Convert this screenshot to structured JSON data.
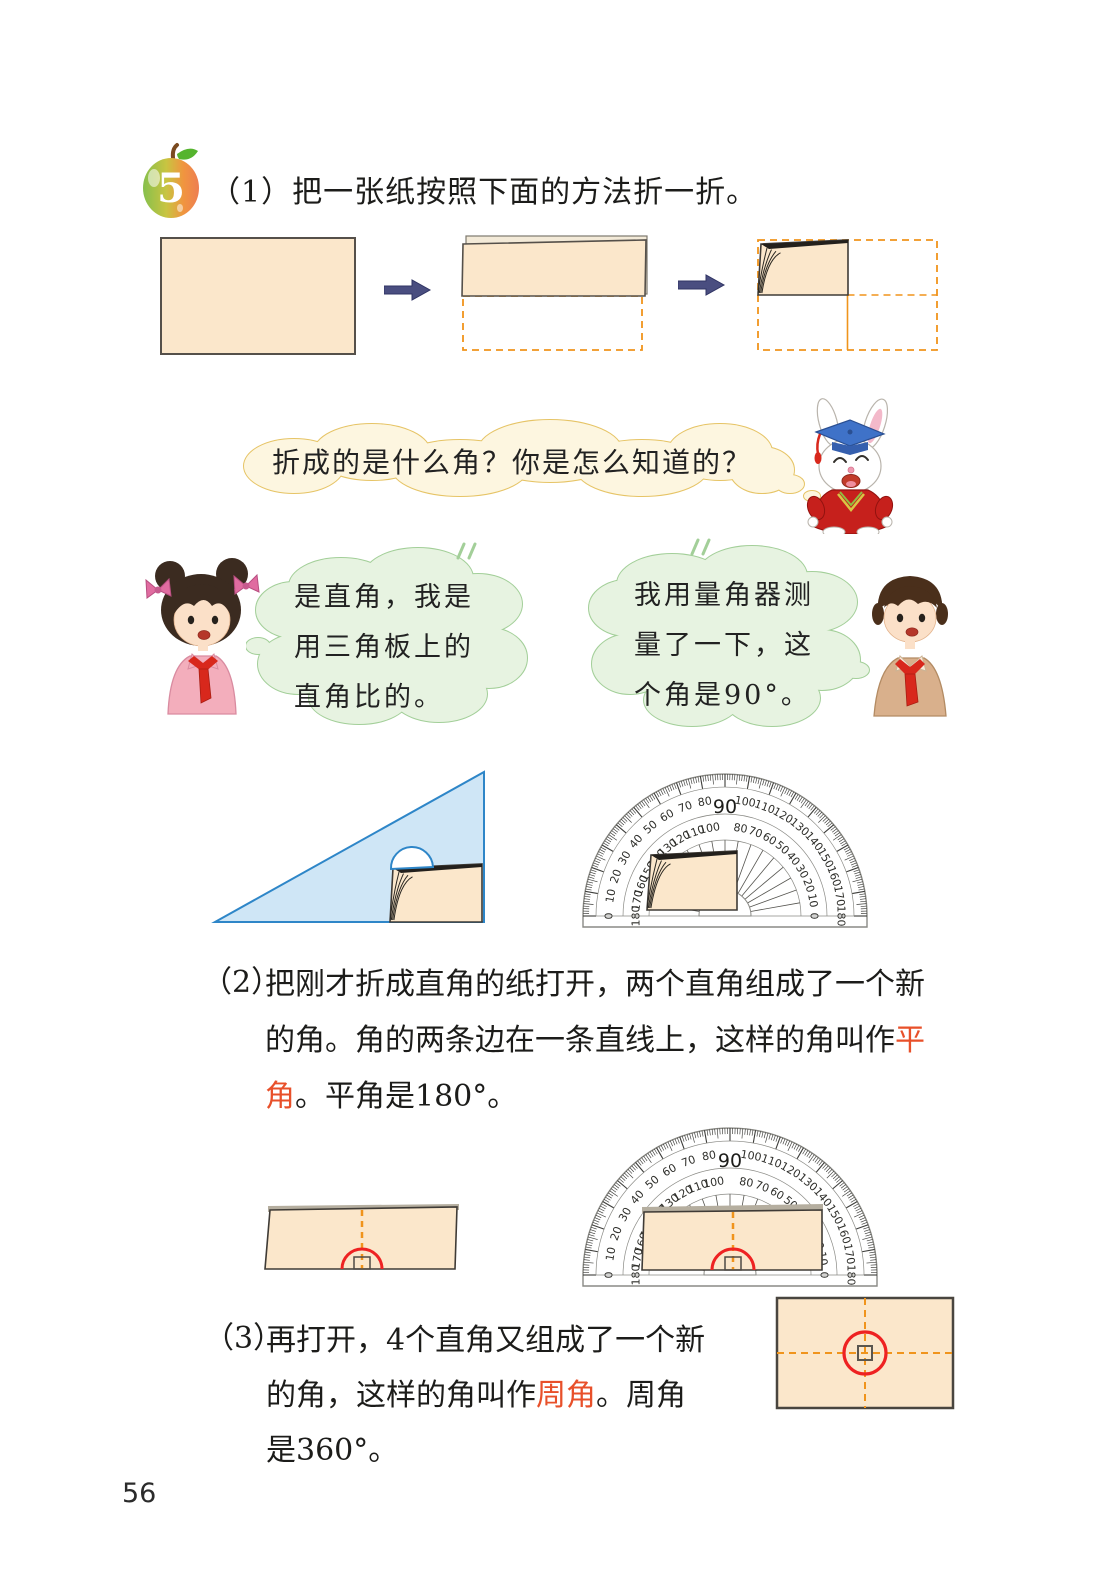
{
  "header": {
    "badge_number": "5",
    "text": "（1）把一张纸按照下面的方法折一折。"
  },
  "bubbles": {
    "rabbit": "折成的是什么角？你是怎么知道的？",
    "girl_lines": [
      "是直角，我是",
      "用三角板上的",
      "直角比的。"
    ],
    "boy_lines": [
      "我用量角器测",
      "量了一下，这",
      "个角是90°。"
    ]
  },
  "paragraph2": {
    "label": "（2）",
    "lines": [
      [
        {
          "t": "把刚才折成直角的纸打开，两个直角组成了一个新"
        }
      ],
      [
        {
          "t": "的角。角的两条边在一条直线上，这样的角叫作"
        },
        {
          "t": "平",
          "red": true
        }
      ],
      [
        {
          "t": "角",
          "red": true
        },
        {
          "t": "。平角是180°。"
        }
      ]
    ]
  },
  "paragraph3": {
    "label": "（3）",
    "lines": [
      [
        {
          "t": "再打开，4个直角又组成了一个新"
        }
      ],
      [
        {
          "t": "的角，这样的角叫作"
        },
        {
          "t": "周角",
          "red": true
        },
        {
          "t": "。周角"
        }
      ],
      [
        {
          "t": "是360°。"
        }
      ]
    ]
  },
  "protractor": {
    "outer_labels": [
      0,
      10,
      20,
      30,
      40,
      50,
      60,
      70,
      80,
      100,
      110,
      120,
      130,
      140,
      150,
      160,
      170,
      180
    ],
    "inner_labels": [
      180,
      170,
      160,
      150,
      140,
      130,
      120,
      110,
      100,
      80,
      70,
      60,
      50,
      40,
      30,
      20,
      10,
      0
    ],
    "top_label": "90"
  },
  "page_number": "56",
  "colors": {
    "paper": "#fbe7cb",
    "paper_border": "#3f3b36",
    "dashed_orange": "#f0941c",
    "arrow_navy": "#4a4e80",
    "triangle_fill": "#cfe6f6",
    "triangle_border": "#2e86c8",
    "green_bubble_fill": "#e7f3e1",
    "green_bubble_border": "#a3cf99",
    "cream_bubble_fill": "#fdf6e0",
    "cream_bubble_border": "#e6c466",
    "red_accent": "#e8502a",
    "red_mark": "#ee2222"
  }
}
